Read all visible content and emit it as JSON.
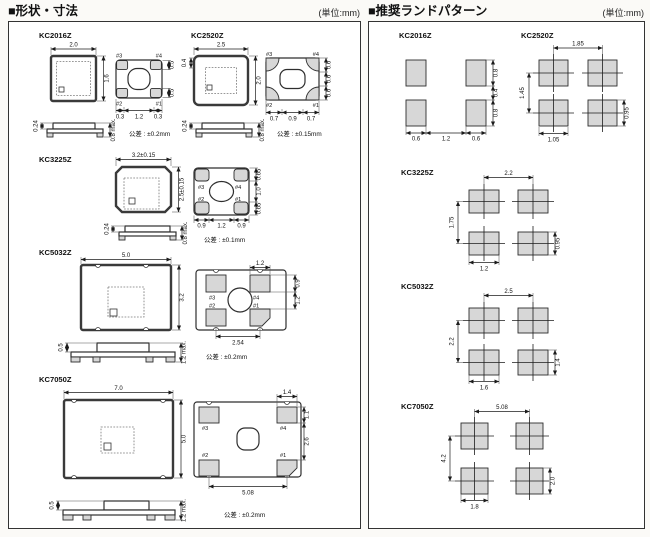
{
  "shape_panel": {
    "title": "■形状・寸法",
    "unit": "(単位:mm)",
    "pin_labels": {
      "p1": "#1",
      "p2": "#2",
      "p3": "#3",
      "p4": "#4"
    },
    "sections": {
      "kc2016z": {
        "name": "KC2016Z",
        "dim_top": "2.0",
        "dim_right": "1.6",
        "pad_b": [
          "0.3",
          "1.2",
          "0.3"
        ],
        "pad_r": [
          "0.5",
          "0.5"
        ],
        "side_left": "0.24",
        "side_right": "0.8 max.",
        "tol": "公差 : ±0.2mm"
      },
      "kc2520z": {
        "name": "KC2520Z",
        "dim_top": "2.5",
        "dim_right": "2.0",
        "edge_dim": "0.4",
        "pad_b": [
          "0.7",
          "0.9",
          "0.7"
        ],
        "pad_r": [
          "0.6",
          "0.6",
          "0.6"
        ],
        "side_left": "0.24",
        "side_right": "0.8 max.",
        "tol": "公差 : ±0.15mm"
      },
      "kc3225z": {
        "name": "KC3225Z",
        "dim_top": "3.2±0.15",
        "dim_right": "2.5±0.15",
        "pad_b": [
          "0.9",
          "1.2",
          "0.9"
        ],
        "pad_r": [
          "0.65",
          "1.0",
          "0.65"
        ],
        "side_left": "0.24",
        "side_right": "0.8 max.",
        "tol": "公差 : ±0.1mm"
      },
      "kc5032z": {
        "name": "KC5032Z",
        "dim_top": "5.0",
        "dim_right": "3.2",
        "pad_top": "1.2",
        "pad_r": [
          "0.9",
          "1.2"
        ],
        "pad_b": "2.54",
        "side_left": "0.5",
        "side_right": "1.2 max.",
        "tol": "公差 : ±0.2mm"
      },
      "kc7050z": {
        "name": "KC7050Z",
        "dim_top": "7.0",
        "dim_right": "5.0",
        "pad_top": "1.4",
        "pad_r": [
          "1.1",
          "2.6"
        ],
        "pad_b": "5.08",
        "side_left": "0.5",
        "side_right": "1.2 max.",
        "tol": "公差 : ±0.2mm"
      }
    }
  },
  "land_panel": {
    "title": "■推奨ランドパターン",
    "unit": "(単位:mm)",
    "sections": {
      "kc2016z": {
        "name": "KC2016Z",
        "right": [
          "0.8",
          "0.4",
          "0.8"
        ],
        "bottom": [
          "0.6",
          "1.2",
          "0.6"
        ]
      },
      "kc2520z": {
        "name": "KC2520Z",
        "pitch_x": "1.85",
        "pitch_y": "1.45",
        "pad_w": "1.05",
        "pad_h": "0.95"
      },
      "kc3225z": {
        "name": "KC3225Z",
        "pitch_x": "2.2",
        "pitch_y": "1.75",
        "pad_w": "1.2",
        "pad_h": "0.95"
      },
      "kc5032z": {
        "name": "KC5032Z",
        "pitch_x": "2.5",
        "pitch_y": "2.2",
        "pad_w": "1.6",
        "pad_h": "1.4"
      },
      "kc7050z": {
        "name": "KC7050Z",
        "pitch_x": "5.08",
        "pitch_y": "4.2",
        "pad_w": "1.8",
        "pad_h": "2.0"
      }
    }
  }
}
